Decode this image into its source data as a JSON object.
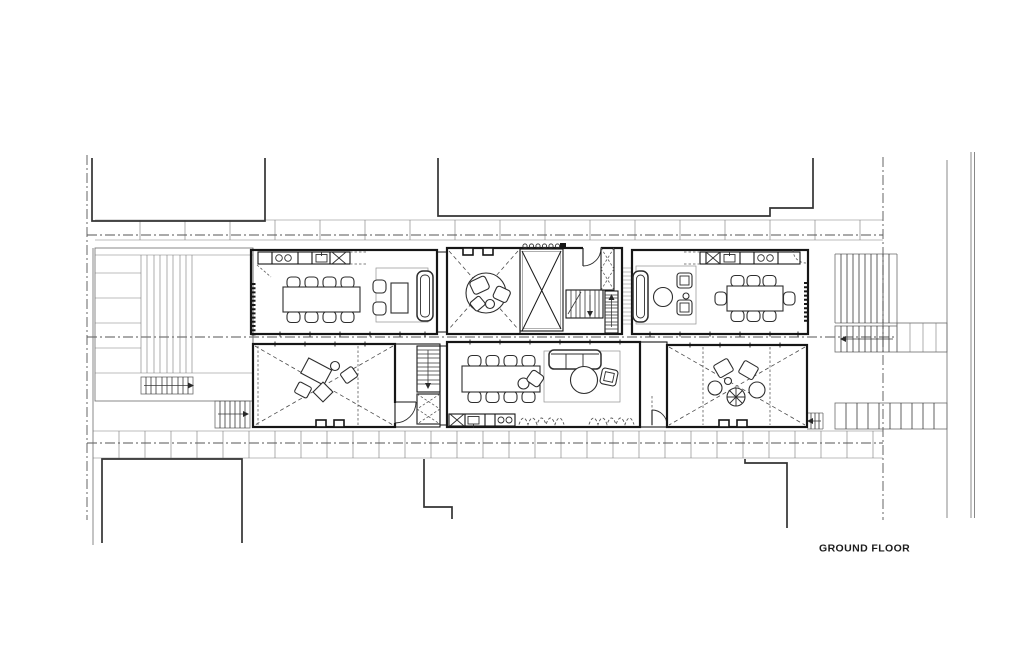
{
  "title": {
    "label": "GROUND FLOOR"
  },
  "palette": {
    "background": "#ffffff",
    "wall_line": "#161616",
    "site_line": "#6b6b6b",
    "furniture_line": "#2e2e2e",
    "boundary_line": "#555555",
    "neighbor_line": "#333333",
    "text_color": "#1c1c1c"
  },
  "plan": {
    "symbols": [
      "dining-table-8-seats",
      "dining-table-8-seats",
      "sofa",
      "armchair",
      "coffee-table",
      "round-table",
      "rug",
      "kitchen-counter-with-sink-and-stove",
      "staircase",
      "door-swing",
      "curtain-line",
      "roof-cross-marks",
      "lounge-chair-group",
      "desk-group",
      "terrace-steps"
    ]
  }
}
